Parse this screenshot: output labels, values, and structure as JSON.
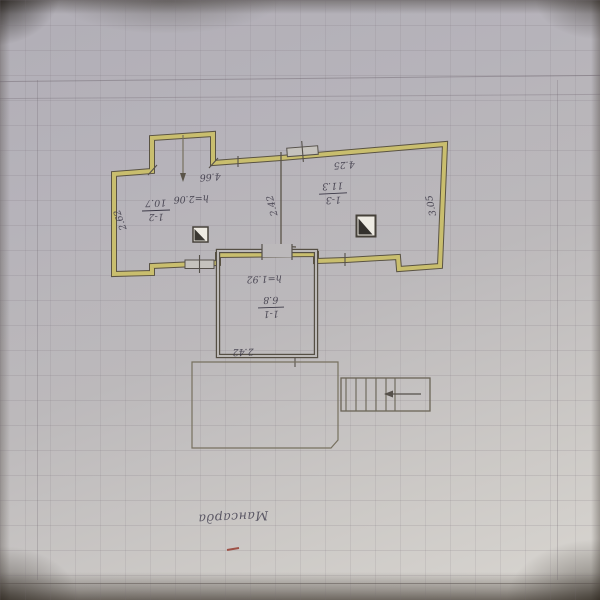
{
  "plan": {
    "floor_label": "Мансарда",
    "rooms": [
      {
        "number": "1-2",
        "area": "10.7",
        "height": "h=2.06"
      },
      {
        "number": "1-3",
        "area": "11.3"
      },
      {
        "number": "1-1",
        "area": "6.8",
        "height": "h=1.92"
      }
    ],
    "dimensions": {
      "room12_width": "4.66",
      "room12_left_wall": "2.62",
      "room13_width": "4.25",
      "room13_right_wall": "3.05",
      "rooms_depth": "2.42",
      "room11_width": "2.42"
    },
    "colors": {
      "wall_highlight": "#c9be6e",
      "ink": "#3c3947",
      "paper": "#bcb9bb"
    }
  }
}
